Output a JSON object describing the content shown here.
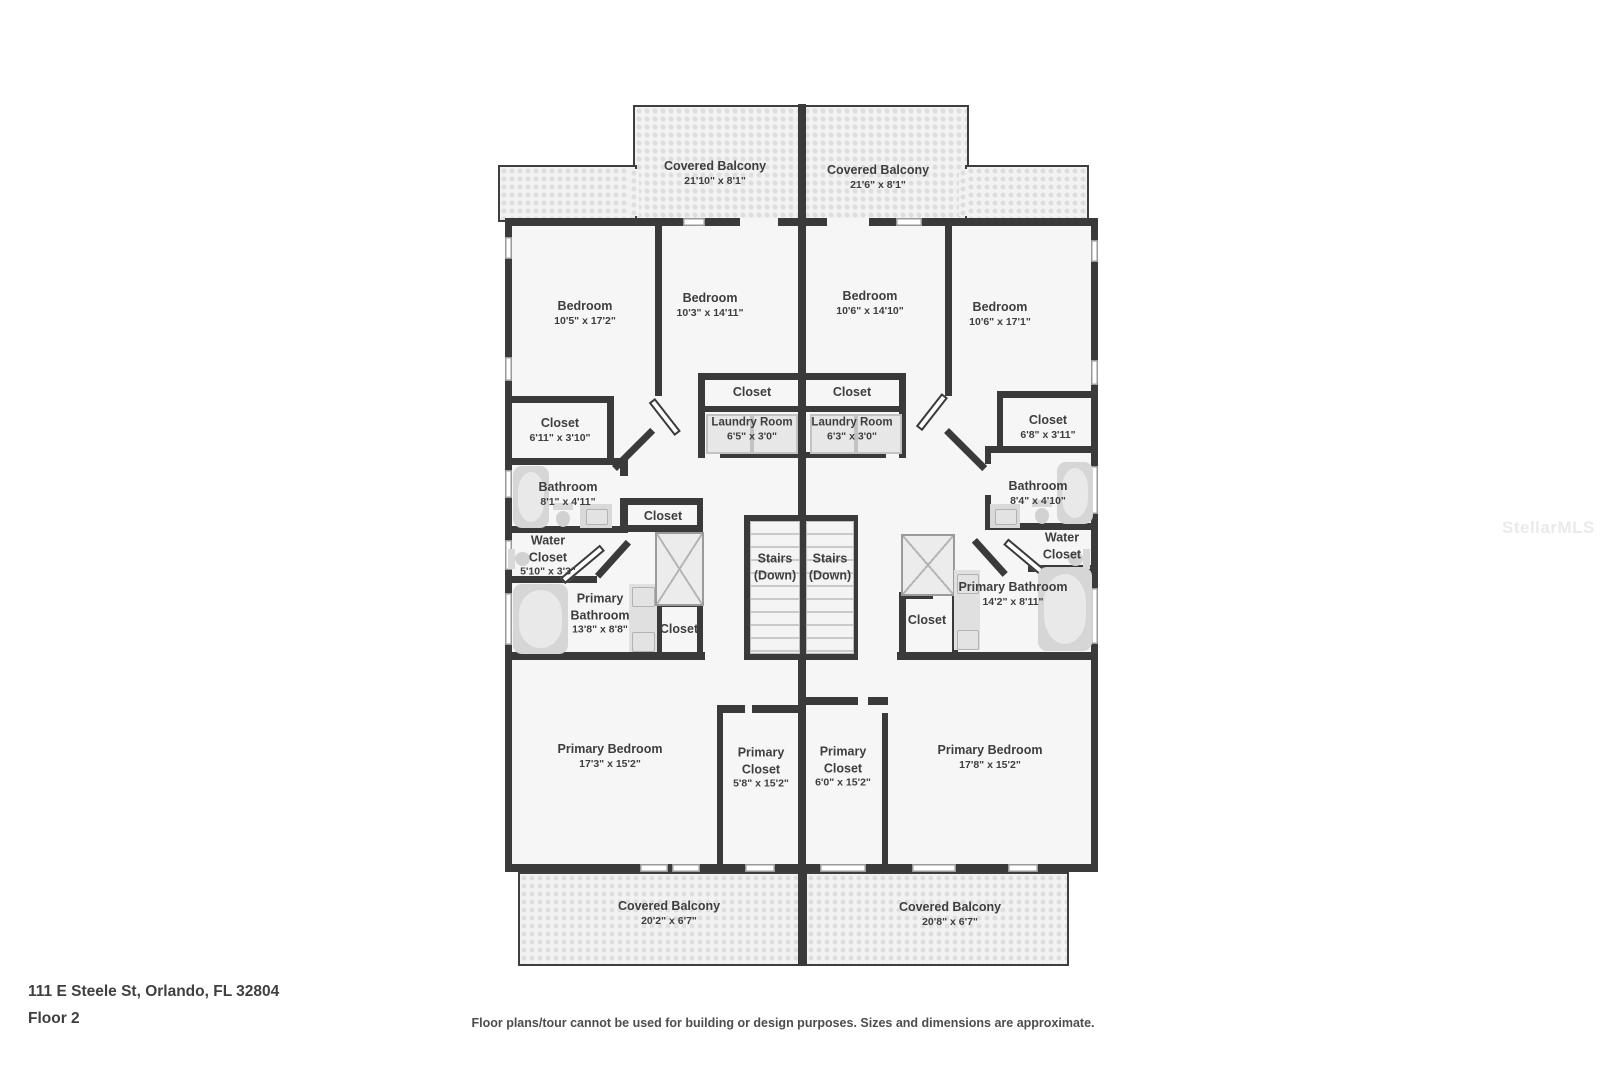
{
  "watermark": "StellarMLS",
  "footer": {
    "address": "111 E Steele St, Orlando, FL 32804",
    "floor": "Floor 2",
    "disclaimer": "Floor plans/tour cannot be used for building or design purposes. Sizes and dimensions are approximate."
  },
  "colors": {
    "wall": "#3a3a3a",
    "room_fill": "#f6f6f6",
    "balcony_fill": "#f2f2f2",
    "fixture_gray": "#d9d9d9",
    "label_text": "#3e3e3e"
  },
  "rooms": {
    "balcony_top_left": {
      "name": "Covered Balcony",
      "dims": "21'10\" x 8'1\""
    },
    "balcony_top_right": {
      "name": "Covered Balcony",
      "dims": "21'6\" x 8'1\""
    },
    "bedroom_1": {
      "name": "Bedroom",
      "dims": "10'5\" x 17'2\""
    },
    "bedroom_2": {
      "name": "Bedroom",
      "dims": "10'3\" x 14'11\""
    },
    "bedroom_3": {
      "name": "Bedroom",
      "dims": "10'6\" x 14'10\""
    },
    "bedroom_4": {
      "name": "Bedroom",
      "dims": "10'6\" x 17'1\""
    },
    "closet_left": {
      "name": "Closet",
      "dims": "6'11\" x 3'10\""
    },
    "closet_center_left": {
      "name": "Closet"
    },
    "closet_center_right": {
      "name": "Closet"
    },
    "laundry_left": {
      "name": "Laundry Room",
      "dims": "6'5\" x 3'0\""
    },
    "laundry_right": {
      "name": "Laundry Room",
      "dims": "6'3\" x 3'0\""
    },
    "closet_right": {
      "name": "Closet",
      "dims": "6'8\" x 3'11\""
    },
    "bathroom_left": {
      "name": "Bathroom",
      "dims": "8'1\" x 4'11\""
    },
    "bathroom_right": {
      "name": "Bathroom",
      "dims": "8'4\" x 4'10\""
    },
    "water_closet_left": {
      "name": "Water Closet",
      "dims": "5'10\" x 3'3\""
    },
    "water_closet_right": {
      "name": "Water Closet"
    },
    "closet_hall_left": {
      "name": "Closet"
    },
    "closet_pb_left": {
      "name": "Closet"
    },
    "closet_pb_right": {
      "name": "Closet"
    },
    "primary_bathroom_left": {
      "name": "Primary Bathroom",
      "dims": "13'8\" x 8'8\""
    },
    "primary_bathroom_right": {
      "name": "Primary Bathroom",
      "dims": "14'2\" x 8'11\""
    },
    "stairs_left": {
      "name": "Stairs",
      "sub": "(Down)"
    },
    "stairs_right": {
      "name": "Stairs",
      "sub": "(Down)"
    },
    "primary_bedroom_left": {
      "name": "Primary Bedroom",
      "dims": "17'3\" x 15'2\""
    },
    "primary_closet_left": {
      "name": "Primary Closet",
      "dims": "5'8\" x 15'2\""
    },
    "primary_closet_right": {
      "name": "Primary Closet",
      "dims": "6'0\" x 15'2\""
    },
    "primary_bedroom_right": {
      "name": "Primary Bedroom",
      "dims": "17'8\" x 15'2\""
    },
    "balcony_bottom_left": {
      "name": "Covered Balcony",
      "dims": "20'2\" x 6'7\""
    },
    "balcony_bottom_right": {
      "name": "Covered Balcony",
      "dims": "20'8\" x 6'7\""
    }
  }
}
